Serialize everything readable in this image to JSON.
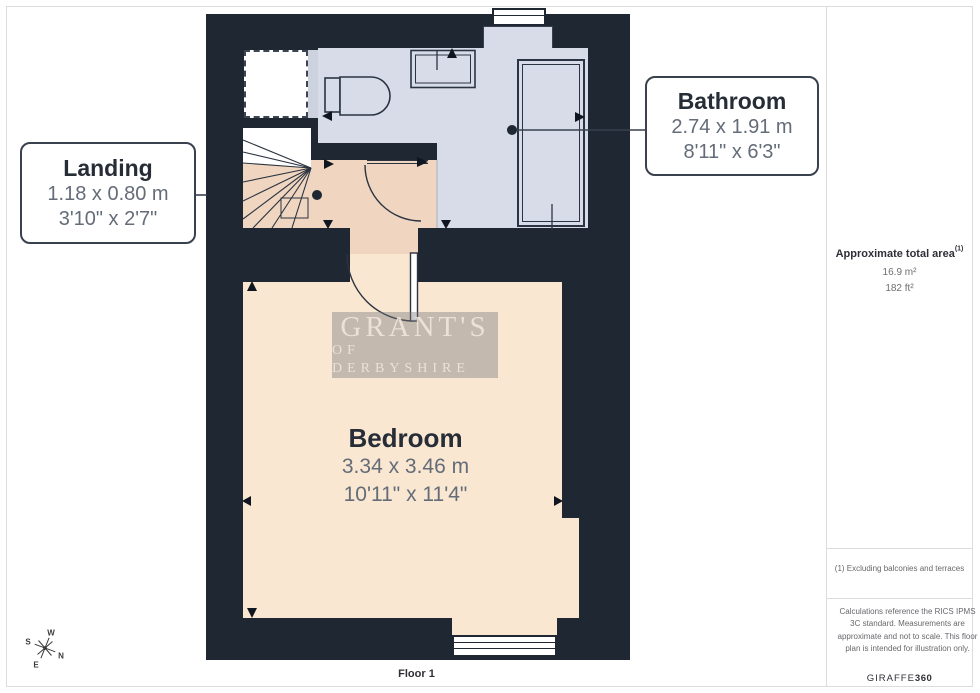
{
  "page": {
    "floor_label": "Floor 1"
  },
  "rooms": {
    "bathroom": {
      "name": "Bathroom",
      "metric": "2.74 x 1.91 m",
      "imperial": "8'11\" x 6'3\""
    },
    "landing": {
      "name": "Landing",
      "metric": "1.18 x 0.80 m",
      "imperial": "3'10\" x 2'7\""
    },
    "bedroom": {
      "name": "Bedroom",
      "metric": "3.34 x 3.46 m",
      "imperial": "10'11\" x 11'4\""
    }
  },
  "watermark": {
    "line1": "GRANT'S",
    "line2": "OF DERBYSHIRE"
  },
  "compass": {
    "n": "N",
    "s": "S",
    "e": "E",
    "w": "W"
  },
  "sidebar": {
    "area_heading": "Approximate total area",
    "area_heading_sup": "(1)",
    "area_m2": "16.9 m²",
    "area_ft2": "182 ft²",
    "footnote": "(1) Excluding balconies and terraces",
    "disclaimer": "Calculations reference the RICS IPMS 3C standard. Measurements are approximate and not to scale. This floor plan is intended for illustration only.",
    "brand": "GIRAFFE",
    "brand_suffix": "360"
  },
  "colors": {
    "wall": "#1f2733",
    "bathroom_floor": "#d8dce8",
    "landing_floor": "#f0d6c1",
    "bedroom_floor": "#f9e7d2",
    "label_border": "#39414f"
  }
}
